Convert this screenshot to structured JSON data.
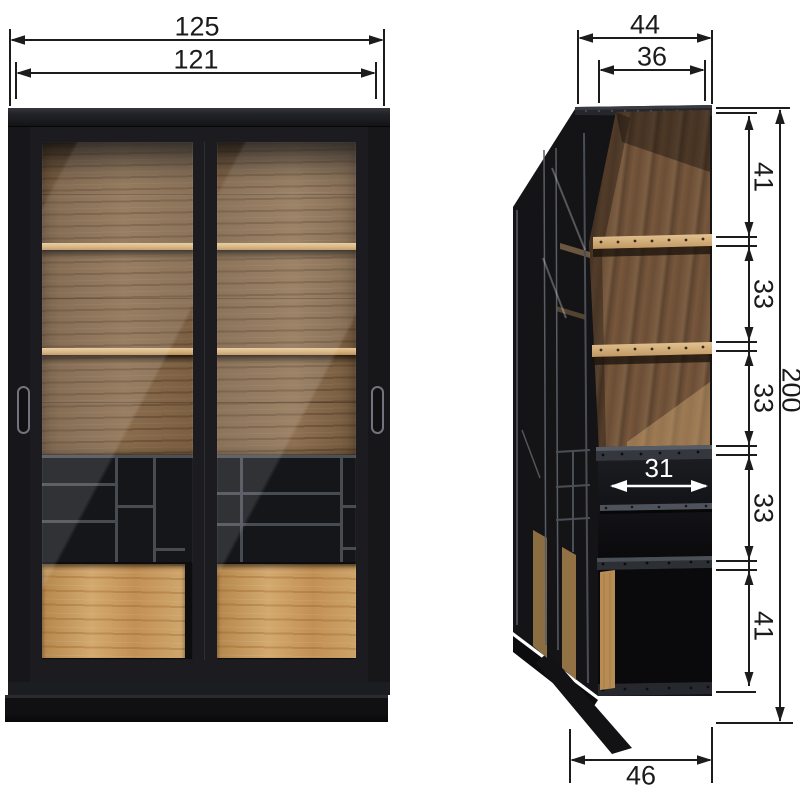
{
  "dimensions": {
    "front_width_outer": "125",
    "front_width_inner": "121",
    "side_depth_outer": "44",
    "side_depth_inner": "36",
    "height_total": "200",
    "height_segments": [
      {
        "value": "41"
      },
      {
        "value": "33"
      },
      {
        "value": "33"
      },
      {
        "value": "33"
      },
      {
        "value": "41"
      }
    ],
    "interior_shelf_depth": "31",
    "base_depth": "46"
  },
  "colors": {
    "background": "#ffffff",
    "cabinet_black": "#17171a",
    "walnut_back_panel": "#7b5f44",
    "oak_light_wood": "#c69a5f",
    "divider_grey": "#474b52",
    "dimension_line": "#1c1c1c",
    "interior_dimension_text": "#ffffff"
  }
}
